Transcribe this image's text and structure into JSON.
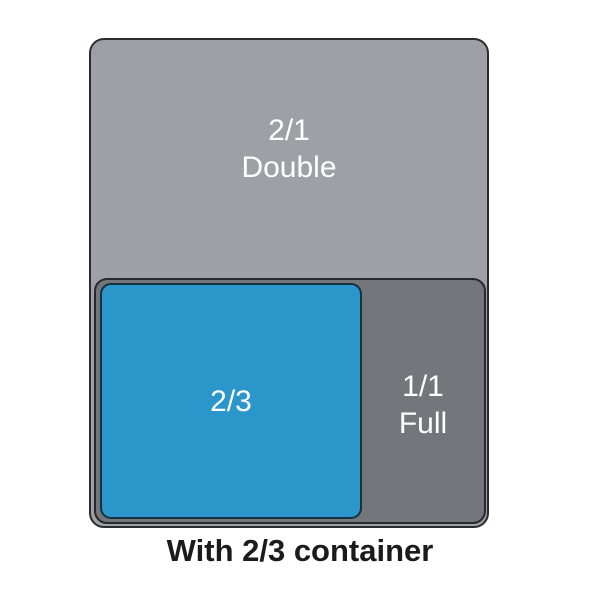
{
  "diagram": {
    "double": {
      "size_label": "2/1",
      "name_label": "Double"
    },
    "full": {
      "size_label": "1/1",
      "name_label": "Full"
    },
    "two_thirds": {
      "size_label": "2/3"
    },
    "caption": "With 2/3 container"
  },
  "colors": {
    "background": "#ffffff",
    "double_fill": "#9da0a4",
    "full_fill": "#73767a",
    "two_thirds_fill": "#2b96c9",
    "outline": "#2b2c30",
    "label_text": "#ffffff",
    "caption_text": "#1b1b1b"
  }
}
